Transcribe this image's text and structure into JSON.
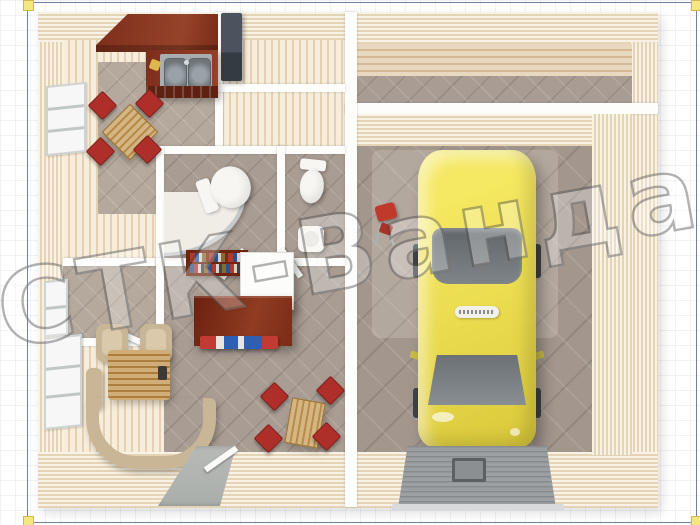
{
  "watermark": {
    "text": "СТК-Ванда",
    "style": "outlined-diagonal"
  },
  "frame": {
    "color": "#72809e",
    "handle_color": "#f2e87f",
    "handles": [
      "top-left",
      "top-right",
      "bottom-left",
      "bottom-right"
    ]
  },
  "palette": {
    "wall_siding": "#f0e2c9",
    "floor_wood": "#f3e4ca",
    "tile_gray": "#a89c93",
    "garage_floor": "#a2968d",
    "interior_wall": "#fdfdfc",
    "car_yellow": "#eadb4e",
    "car_glass": "#70767a",
    "chair_red": "#ae2f2a",
    "kitchen_cabinet_mahogany": "#7e2f1b",
    "wood_furniture": "#c79d5a",
    "sofa_beige": "#c9b697",
    "ramp_gray": "#9ca0a3"
  },
  "scene": {
    "view": "top-down 3D floor plan of a house with attached single-car garage",
    "areas": [
      "kitchen-dining",
      "entry-hall",
      "bathroom-with-shower",
      "wc",
      "pantry",
      "living-room",
      "terrace-corridor",
      "garage"
    ],
    "objects": [
      "kitchen-counter",
      "double-sink",
      "cutting-board",
      "refrigerator",
      "dining-table-with-red-chairs",
      "window",
      "toilet",
      "corner-shower",
      "wash-basin",
      "bookcase",
      "white-cabinet",
      "sideboard-with-books",
      "armchairs",
      "corner-sofa",
      "coffee-table",
      "second-dining-set",
      "yellow-car",
      "tool-cart",
      "garage-ramp-with-drain",
      "entrance-walkway",
      "doors"
    ]
  }
}
